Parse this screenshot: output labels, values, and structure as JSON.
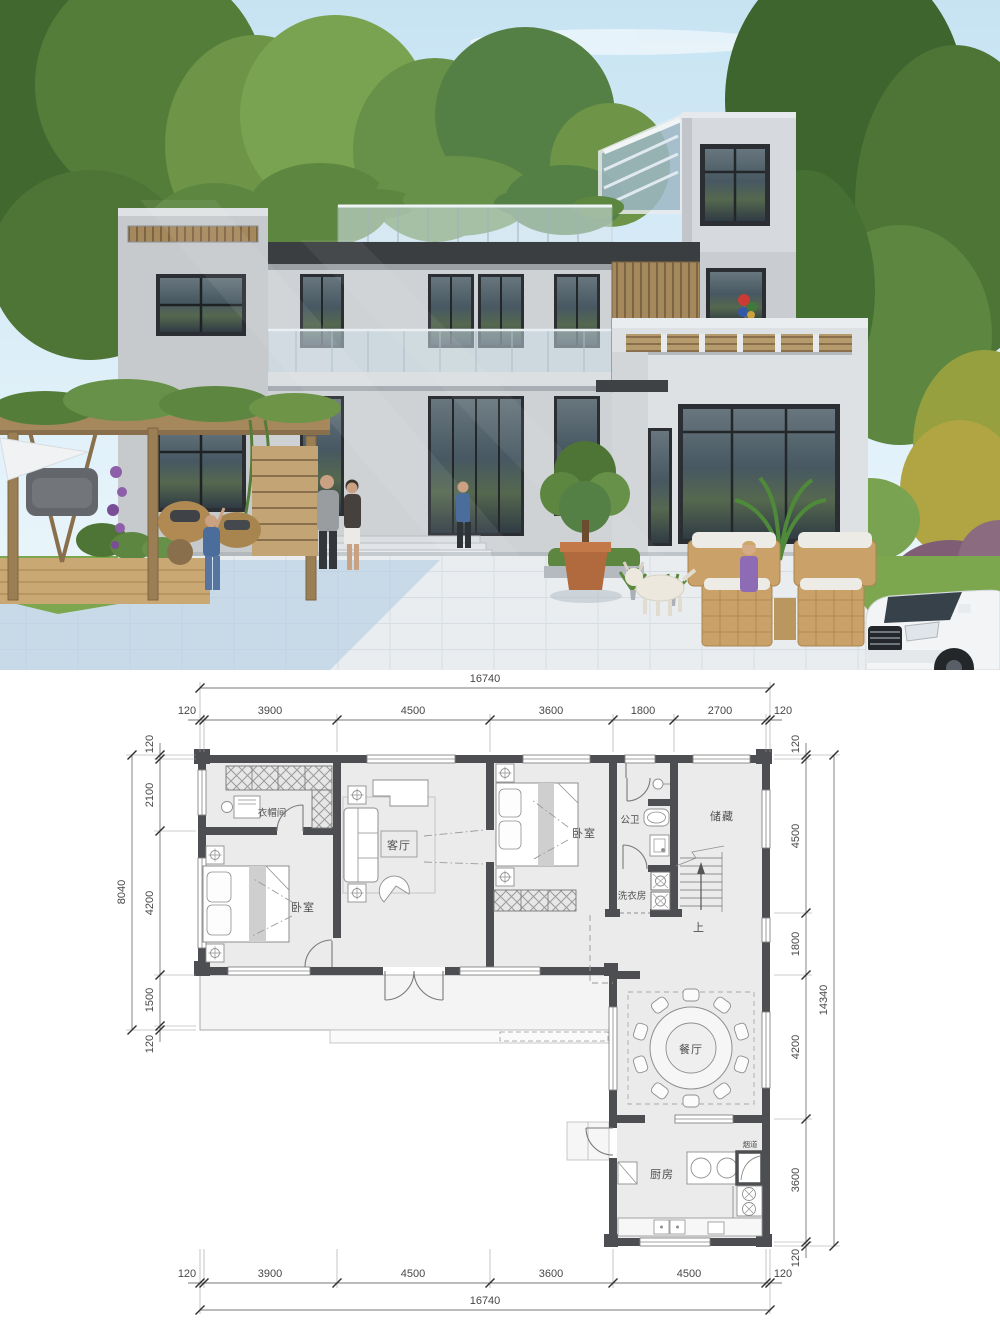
{
  "plan": {
    "rooms": {
      "cloakroom": "衣帽间",
      "living_room": "客厅",
      "bedroom_left": "卧室",
      "bedroom_right": "卧室",
      "bathroom": "公卫",
      "storage": "储藏",
      "laundry": "洗衣房",
      "dining_room": "餐厅",
      "kitchen": "厨房",
      "flue": "烟道",
      "stair_up": "上"
    },
    "dims": {
      "top_total": "16740",
      "top_segments": [
        "120",
        "3900",
        "4500",
        "3600",
        "1800",
        "2700",
        "120"
      ],
      "bottom_total": "16740",
      "bottom_segments": [
        "120",
        "3900",
        "4500",
        "3600",
        "4500",
        "120"
      ],
      "left_total": "8040",
      "left_segments": [
        "120",
        "2100",
        "4200",
        "1500",
        "120"
      ],
      "right_total": "14340",
      "right_segments": [
        "120",
        "4500",
        "1800",
        "4200",
        "3600",
        "120"
      ]
    },
    "colors": {
      "wall": "#4c4e51",
      "floor": "#ebebeb",
      "dim_text": "#474747"
    }
  },
  "photo": {
    "colors": {
      "sky": "#c7e3f2",
      "facade": "#ced2d5",
      "roof_band": "#3b3e41",
      "wood": "#a5885c",
      "pavement": "#e9edf0",
      "lawn": "#7da74f"
    }
  }
}
